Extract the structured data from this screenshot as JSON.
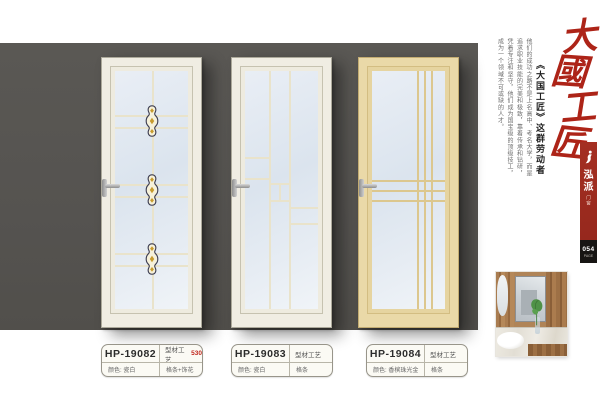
{
  "panel": {
    "color": "#555350"
  },
  "doors": [
    {
      "name": "door-hp-19082",
      "design": "center-rail-with-three-ornaments",
      "frame_color": "#f0ede3"
    },
    {
      "name": "door-hp-19083",
      "design": "offset-step-grid",
      "frame_color": "#f0ede3"
    },
    {
      "name": "door-hp-19084",
      "design": "triple-vertical-triple-horizontal",
      "frame_color": "#ead9a8"
    }
  ],
  "labels": [
    {
      "model": "HP-19082",
      "craft": "型材工艺",
      "craft_num": "530",
      "color": "颜色: 瓷白",
      "feature": "格条+饰花"
    },
    {
      "model": "HP-19083",
      "craft": "型材工艺",
      "craft_num": "",
      "color": "颜色: 瓷白",
      "feature": "格条"
    },
    {
      "model": "HP-19084",
      "craft": "型材工艺",
      "craft_num": "",
      "color": "颜色: 香槟珠光金",
      "feature": "格条"
    }
  ],
  "right_text": {
    "calligraphy_chars": [
      "大",
      "國",
      "工",
      "匠"
    ],
    "subtitle": "《大国工匠》这群劳动者",
    "paragraph": "他们的成功之路不是上名高中、考名大学，而是追求职业技能的完美和极致，靠着传承和钻研，凭着专注和坚守，他们成为国宝级的顶级技工，成为一个领域不可或缺的人才。",
    "accent_color": "#ad2418"
  },
  "side_tab": {
    "brand_char_1": "泓",
    "brand_char_2": "派",
    "brand_sub": "门窗",
    "tab_color": "#9c2d22",
    "page_number": "054",
    "page_label": "PAGE"
  }
}
